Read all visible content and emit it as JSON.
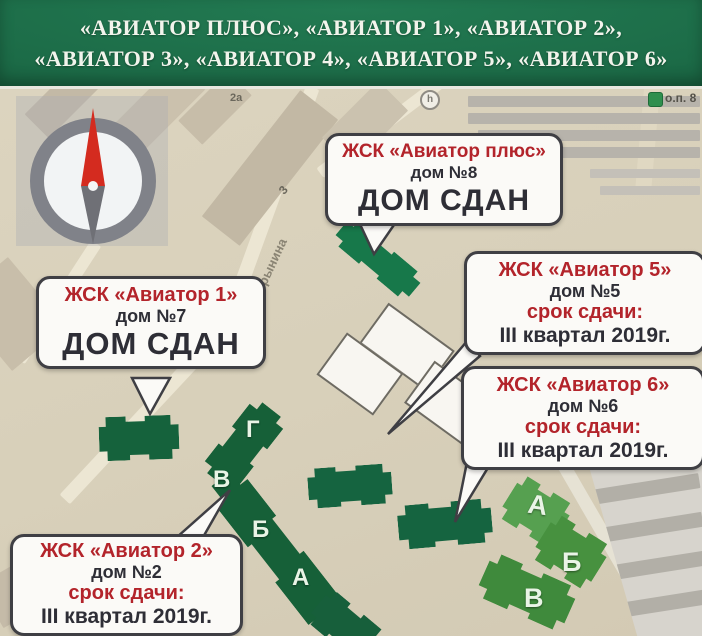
{
  "header": {
    "line1": "«АВИАТОР ПЛЮС», «АВИАТОР 1», «АВИАТОР 2»,",
    "line2": "«АВИАТОР 3», «АВИАТОР 4», «АВИАТОР 5», «АВИАТОР 6»"
  },
  "map": {
    "street_label": "Трынина",
    "labels": {
      "block_2a": "2а",
      "block_3": "3",
      "marker_h": "h",
      "bus_stop": "о.п. 8"
    },
    "buildings": {
      "house2_sections": [
        "Г",
        "В",
        "Б",
        "А"
      ],
      "house34_sections": [
        "А",
        "Б",
        "В"
      ]
    },
    "callouts": {
      "plus": {
        "title": "ЖСК «Авиатор плюс»",
        "house": "дом №8",
        "status": "ДОМ СДАН"
      },
      "a1": {
        "title": "ЖСК «Авиатор 1»",
        "house": "дом №7",
        "status": "ДОМ СДАН"
      },
      "a5": {
        "title": "ЖСК «Авиатор 5»",
        "house": "дом №5",
        "deadline_label": "срок сдачи:",
        "deadline": "III квартал 2019г."
      },
      "a6": {
        "title": "ЖСК «Авиатор 6»",
        "house": "дом №6",
        "deadline_label": "срок сдачи:",
        "deadline": "III квартал 2019г."
      },
      "a2": {
        "title": "ЖСК «Авиатор 2»",
        "house": "дом №2",
        "deadline_label": "срок сдачи:",
        "deadline": "III квартал 2019г."
      }
    },
    "colors": {
      "header_green": "#1c6b47",
      "callout_red": "#b3242b",
      "built_green": "#15663f",
      "new_green": "#4a9245",
      "map_beige": "#d8d0bb"
    }
  }
}
